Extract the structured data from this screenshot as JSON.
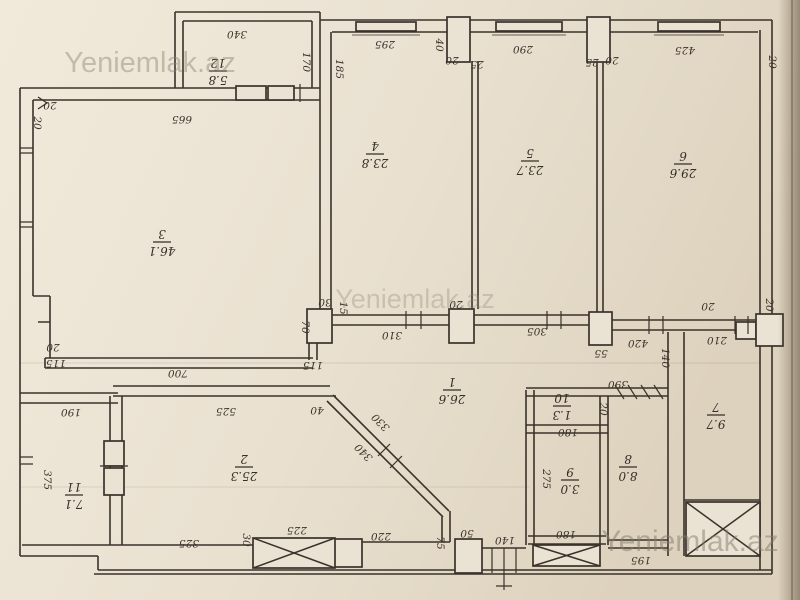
{
  "watermark": {
    "text": "Yeniemlak.az"
  },
  "plan": {
    "rooms": [
      {
        "num": "1",
        "area": "26.6",
        "x": 452,
        "y": 391
      },
      {
        "num": "2",
        "area": "25.3",
        "x": 244,
        "y": 468
      },
      {
        "num": "3",
        "area": "46.1",
        "x": 162,
        "y": 243
      },
      {
        "num": "4",
        "area": "23.8",
        "x": 375,
        "y": 155
      },
      {
        "num": "5",
        "area": "23.7",
        "x": 530,
        "y": 162
      },
      {
        "num": "6",
        "area": "29.6",
        "x": 683,
        "y": 165
      },
      {
        "num": "7",
        "area": "9.7",
        "x": 716,
        "y": 416
      },
      {
        "num": "8",
        "area": "8.0",
        "x": 628,
        "y": 468
      },
      {
        "num": "9",
        "area": "3.0",
        "x": 570,
        "y": 481
      },
      {
        "num": "10",
        "area": "1.3",
        "x": 562,
        "y": 407
      },
      {
        "num": "11",
        "area": "7.1",
        "x": 74,
        "y": 496
      },
      {
        "num": "12",
        "area": "5.8",
        "x": 218,
        "y": 72
      }
    ],
    "dims": [
      {
        "t": "340",
        "x": 237,
        "y": 31,
        "r": 180
      },
      {
        "t": "170",
        "x": 303,
        "y": 62,
        "r": 90
      },
      {
        "t": "665",
        "x": 182,
        "y": 116,
        "r": 180
      },
      {
        "t": "20",
        "x": 50,
        "y": 102,
        "r": 180
      },
      {
        "t": "20",
        "x": 34,
        "y": 123,
        "r": 90
      },
      {
        "t": "185",
        "x": 336,
        "y": 69,
        "r": 90
      },
      {
        "t": "295",
        "x": 385,
        "y": 41,
        "r": 180
      },
      {
        "t": "40",
        "x": 436,
        "y": 45,
        "r": 90
      },
      {
        "t": "20",
        "x": 452,
        "y": 57,
        "r": 180
      },
      {
        "t": "25",
        "x": 477,
        "y": 61,
        "r": 180
      },
      {
        "t": "290",
        "x": 523,
        "y": 46,
        "r": 180
      },
      {
        "t": "25",
        "x": 592,
        "y": 59,
        "r": 180
      },
      {
        "t": "20",
        "x": 612,
        "y": 57,
        "r": 180
      },
      {
        "t": "425",
        "x": 685,
        "y": 47,
        "r": 180
      },
      {
        "t": "20",
        "x": 769,
        "y": 62,
        "r": 90
      },
      {
        "t": "30",
        "x": 325,
        "y": 299,
        "r": 180
      },
      {
        "t": "15",
        "x": 340,
        "y": 308,
        "r": 90
      },
      {
        "t": "70",
        "x": 302,
        "y": 327,
        "r": 90
      },
      {
        "t": "310",
        "x": 392,
        "y": 332,
        "r": 180
      },
      {
        "t": "20",
        "x": 456,
        "y": 301,
        "r": 180
      },
      {
        "t": "305",
        "x": 537,
        "y": 328,
        "r": 180
      },
      {
        "t": "20",
        "x": 708,
        "y": 303,
        "r": 180
      },
      {
        "t": "55",
        "x": 601,
        "y": 350,
        "r": 180
      },
      {
        "t": "420",
        "x": 638,
        "y": 340,
        "r": 180
      },
      {
        "t": "210",
        "x": 717,
        "y": 337,
        "r": 180
      },
      {
        "t": "20",
        "x": 766,
        "y": 305,
        "r": 90
      },
      {
        "t": "140",
        "x": 662,
        "y": 358,
        "r": 90
      },
      {
        "t": "390",
        "x": 618,
        "y": 381,
        "r": 180
      },
      {
        "t": "20",
        "x": 600,
        "y": 409,
        "r": 90
      },
      {
        "t": "180",
        "x": 568,
        "y": 429,
        "r": 180
      },
      {
        "t": "275",
        "x": 543,
        "y": 479,
        "r": 90
      },
      {
        "t": "180",
        "x": 566,
        "y": 531,
        "r": 180
      },
      {
        "t": "195",
        "x": 641,
        "y": 557,
        "r": 180
      },
      {
        "t": "115",
        "x": 313,
        "y": 362,
        "r": 180
      },
      {
        "t": "40",
        "x": 317,
        "y": 407,
        "r": 180
      },
      {
        "t": "330",
        "x": 383,
        "y": 420,
        "r": 225
      },
      {
        "t": "340",
        "x": 366,
        "y": 450,
        "r": 225
      },
      {
        "t": "525",
        "x": 226,
        "y": 408,
        "r": 180
      },
      {
        "t": "700",
        "x": 178,
        "y": 370,
        "r": 180
      },
      {
        "t": "20",
        "x": 53,
        "y": 344,
        "r": 180
      },
      {
        "t": "115",
        "x": 56,
        "y": 360,
        "r": 180
      },
      {
        "t": "190",
        "x": 71,
        "y": 409,
        "r": 180
      },
      {
        "t": "375",
        "x": 44,
        "y": 480,
        "r": 90
      },
      {
        "t": "325",
        "x": 189,
        "y": 540,
        "r": 180
      },
      {
        "t": "30",
        "x": 243,
        "y": 540,
        "r": 90
      },
      {
        "t": "225",
        "x": 297,
        "y": 527,
        "r": 180
      },
      {
        "t": "220",
        "x": 381,
        "y": 533,
        "r": 180
      },
      {
        "t": "75",
        "x": 437,
        "y": 543,
        "r": 90
      },
      {
        "t": "50",
        "x": 467,
        "y": 530,
        "r": 180
      },
      {
        "t": "140",
        "x": 505,
        "y": 537,
        "r": 180
      }
    ]
  }
}
